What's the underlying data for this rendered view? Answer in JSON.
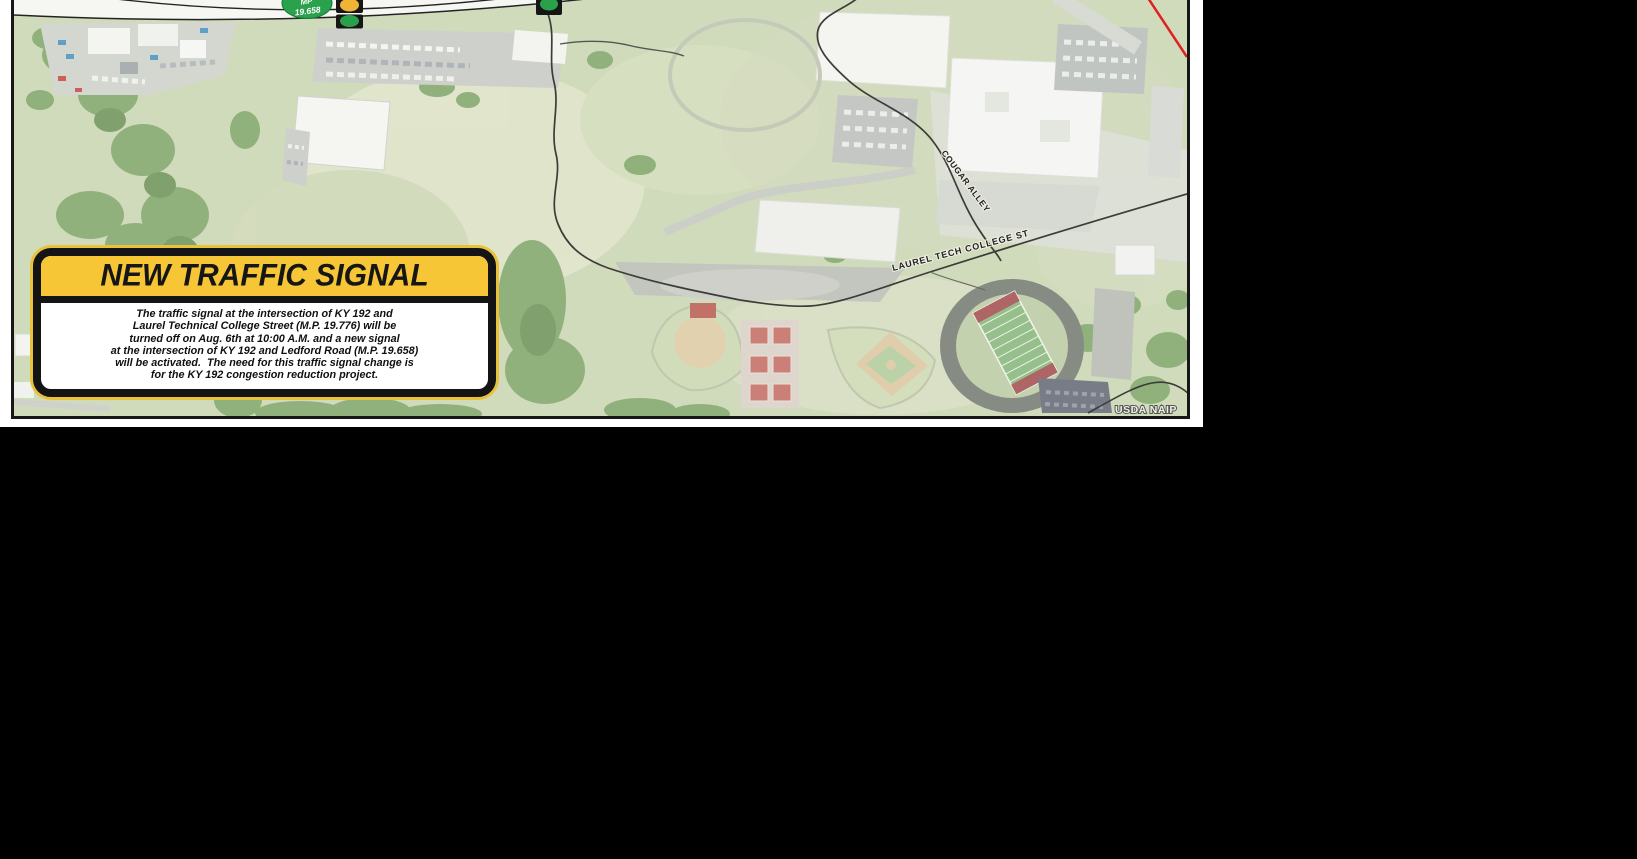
{
  "page": {
    "background": "#000000",
    "paper": "#ffffff"
  },
  "map": {
    "attribution": "USDA NAIP",
    "milepost_badge": {
      "line1": "MP",
      "line2": "19.658",
      "color": "#2aa14c"
    },
    "street_labels": {
      "cougar_alley": "COUGAR ALLEY",
      "laurel_tech": "LAUREL TECH COLLEGE ST"
    },
    "signals": {
      "yellow_light_color": "#f0b434",
      "green_light_color": "#2ba04a",
      "housing_color": "#161616"
    },
    "route_highlight_color": "#e02020"
  },
  "callout": {
    "title": "NEW TRAFFIC SIGNAL",
    "banner_color": "#f6c636",
    "body_lines": [
      "The traffic signal at the intersection of KY 192 and",
      "Laurel Technical College Street (M.P. 19.776) will be",
      "turned off on Aug. 6th at 10:00 A.M. and a new signal",
      "at the intersection of KY 192 and Ledford Road (M.P. 19.658)",
      "will be activated.  The need for this traffic signal change is",
      "for the KY 192 congestion reduction project."
    ]
  }
}
